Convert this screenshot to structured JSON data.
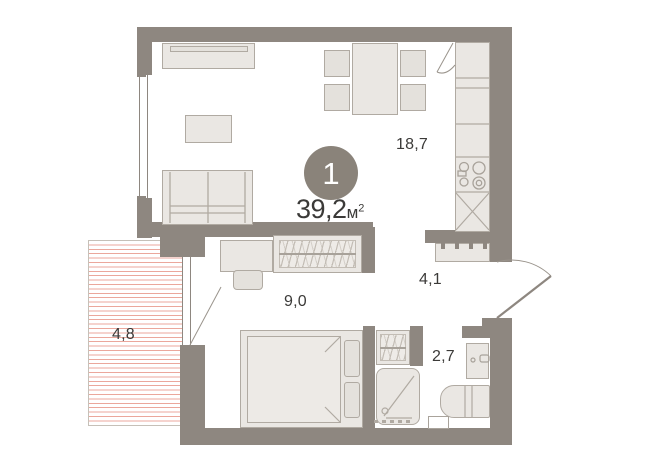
{
  "plan": {
    "unit_badge": "1",
    "total_area": "39,2",
    "area_unit": "м",
    "area_sup": "2",
    "rooms": {
      "kitchen_living": "18,7",
      "bedroom": "9,0",
      "hallway": "4,1",
      "bathroom": "2,7",
      "balcony": "4,8"
    },
    "colors": {
      "wall": "#8e8780",
      "furniture_fill": "#eae7e3",
      "furniture_border": "#b0aaa2",
      "balcony_hatch": "#eba79c",
      "text": "#3b3a38",
      "badge": "#8a837a"
    }
  }
}
